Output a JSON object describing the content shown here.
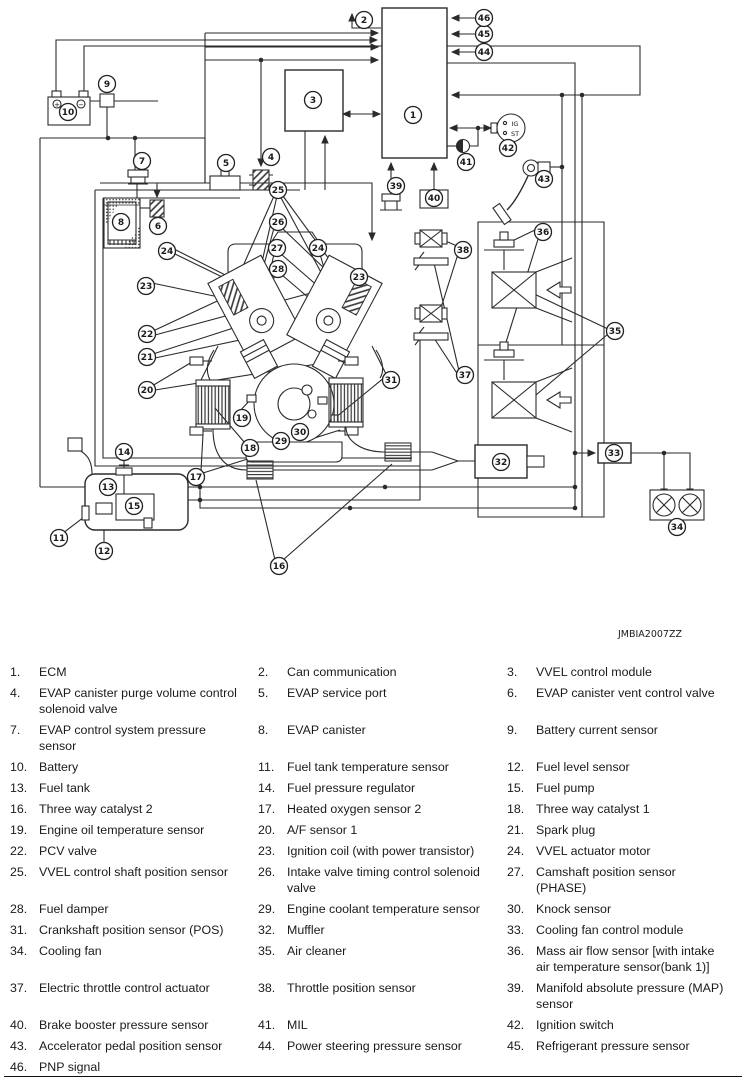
{
  "diagram": {
    "figure_code": "JMBIA2007ZZ",
    "battery": {
      "positive": "+",
      "negative": "−"
    },
    "ignition_switch": {
      "line1": "IG",
      "line2": "ST"
    },
    "callouts": [
      {
        "n": "1",
        "x": 413,
        "y": 115
      },
      {
        "n": "2",
        "x": 364,
        "y": 20
      },
      {
        "n": "3",
        "x": 313,
        "y": 100
      },
      {
        "n": "4",
        "x": 271,
        "y": 157
      },
      {
        "n": "5",
        "x": 226,
        "y": 163
      },
      {
        "n": "6",
        "x": 158,
        "y": 226
      },
      {
        "n": "7",
        "x": 142,
        "y": 161
      },
      {
        "n": "8",
        "x": 121,
        "y": 222
      },
      {
        "n": "9",
        "x": 107,
        "y": 84
      },
      {
        "n": "10",
        "x": 68,
        "y": 112
      },
      {
        "n": "11",
        "x": 59,
        "y": 538
      },
      {
        "n": "12",
        "x": 104,
        "y": 551
      },
      {
        "n": "13",
        "x": 108,
        "y": 487
      },
      {
        "n": "14",
        "x": 124,
        "y": 452
      },
      {
        "n": "15",
        "x": 134,
        "y": 506
      },
      {
        "n": "16",
        "x": 279,
        "y": 566
      },
      {
        "n": "17",
        "x": 196,
        "y": 477
      },
      {
        "n": "18",
        "x": 250,
        "y": 448
      },
      {
        "n": "19",
        "x": 242,
        "y": 418
      },
      {
        "n": "20",
        "x": 147,
        "y": 390
      },
      {
        "n": "21",
        "x": 147,
        "y": 357
      },
      {
        "n": "22",
        "x": 147,
        "y": 334
      },
      {
        "n": "23",
        "x": 146,
        "y": 286
      },
      {
        "n": "23",
        "x": 359,
        "y": 277
      },
      {
        "n": "24",
        "x": 167,
        "y": 251
      },
      {
        "n": "24",
        "x": 318,
        "y": 248
      },
      {
        "n": "25",
        "x": 278,
        "y": 190
      },
      {
        "n": "26",
        "x": 278,
        "y": 222
      },
      {
        "n": "27",
        "x": 277,
        "y": 248
      },
      {
        "n": "28",
        "x": 278,
        "y": 269
      },
      {
        "n": "29",
        "x": 281,
        "y": 441
      },
      {
        "n": "30",
        "x": 300,
        "y": 432
      },
      {
        "n": "31",
        "x": 391,
        "y": 380
      },
      {
        "n": "32",
        "x": 501,
        "y": 462
      },
      {
        "n": "33",
        "x": 614,
        "y": 453
      },
      {
        "n": "34",
        "x": 677,
        "y": 527
      },
      {
        "n": "35",
        "x": 615,
        "y": 331
      },
      {
        "n": "36",
        "x": 543,
        "y": 232
      },
      {
        "n": "37",
        "x": 465,
        "y": 375
      },
      {
        "n": "38",
        "x": 463,
        "y": 250
      },
      {
        "n": "39",
        "x": 396,
        "y": 186
      },
      {
        "n": "40",
        "x": 434,
        "y": 198
      },
      {
        "n": "41",
        "x": 466,
        "y": 162
      },
      {
        "n": "42",
        "x": 508,
        "y": 148
      },
      {
        "n": "43",
        "x": 544,
        "y": 179
      },
      {
        "n": "44",
        "x": 484,
        "y": 52
      },
      {
        "n": "45",
        "x": 484,
        "y": 34
      },
      {
        "n": "46",
        "x": 484,
        "y": 18
      }
    ]
  },
  "legend": {
    "rows": [
      [
        {
          "num": "1.",
          "label": "ECM"
        },
        {
          "num": "2.",
          "label": "Can communication"
        },
        {
          "num": "3.",
          "label": "VVEL control module"
        }
      ],
      [
        {
          "num": "4.",
          "label": "EVAP canister purge volume control solenoid valve"
        },
        {
          "num": "5.",
          "label": "EVAP service port"
        },
        {
          "num": "6.",
          "label": "EVAP canister vent control valve"
        }
      ],
      [
        {
          "num": "7.",
          "label": "EVAP control system pressure sensor"
        },
        {
          "num": "8.",
          "label": "EVAP canister"
        },
        {
          "num": "9.",
          "label": "Battery current sensor"
        }
      ],
      [
        {
          "num": "10.",
          "label": "Battery"
        },
        {
          "num": "11.",
          "label": "Fuel tank temperature sensor"
        },
        {
          "num": "12.",
          "label": "Fuel level sensor"
        }
      ],
      [
        {
          "num": "13.",
          "label": "Fuel tank"
        },
        {
          "num": "14.",
          "label": "Fuel pressure regulator"
        },
        {
          "num": "15.",
          "label": "Fuel pump"
        }
      ],
      [
        {
          "num": "16.",
          "label": "Three way catalyst 2"
        },
        {
          "num": "17.",
          "label": "Heated oxygen sensor 2"
        },
        {
          "num": "18.",
          "label": "Three way catalyst 1"
        }
      ],
      [
        {
          "num": "19.",
          "label": "Engine oil temperature sensor"
        },
        {
          "num": "20.",
          "label": "A/F sensor 1"
        },
        {
          "num": "21.",
          "label": "Spark plug"
        }
      ],
      [
        {
          "num": "22.",
          "label": "PCV valve"
        },
        {
          "num": "23.",
          "label": "Ignition coil (with power transistor)"
        },
        {
          "num": "24.",
          "label": "VVEL actuator motor"
        }
      ],
      [
        {
          "num": "25.",
          "label": "VVEL control shaft position sensor"
        },
        {
          "num": "26.",
          "label": "Intake valve timing control solenoid valve"
        },
        {
          "num": "27.",
          "label": "Camshaft position sensor (PHASE)"
        }
      ],
      [
        {
          "num": "28.",
          "label": "Fuel damper"
        },
        {
          "num": "29.",
          "label": "Engine coolant temperature sensor"
        },
        {
          "num": "30.",
          "label": "Knock sensor"
        }
      ],
      [
        {
          "num": "31.",
          "label": "Crankshaft position sensor (POS)"
        },
        {
          "num": "32.",
          "label": "Muffler"
        },
        {
          "num": "33.",
          "label": "Cooling fan control module"
        }
      ],
      [
        {
          "num": "34.",
          "label": "Cooling fan"
        },
        {
          "num": "35.",
          "label": "Air cleaner"
        },
        {
          "num": "36.",
          "label": "Mass air flow sensor [with intake air temperature sensor(bank 1)]"
        }
      ],
      [
        {
          "num": "37.",
          "label": "Electric throttle control actuator"
        },
        {
          "num": "38.",
          "label": "Throttle position sensor"
        },
        {
          "num": "39.",
          "label": "Manifold absolute pressure (MAP) sensor"
        }
      ],
      [
        {
          "num": "40.",
          "label": "Brake booster pressure sensor"
        },
        {
          "num": "41.",
          "label": "MIL"
        },
        {
          "num": "42.",
          "label": "Ignition switch"
        }
      ],
      [
        {
          "num": "43.",
          "label": "Accelerator pedal position sensor"
        },
        {
          "num": "44.",
          "label": "Power steering pressure sensor"
        },
        {
          "num": "45.",
          "label": "Refrigerant pressure sensor"
        }
      ],
      [
        {
          "num": "46.",
          "label": "PNP signal"
        }
      ]
    ]
  }
}
